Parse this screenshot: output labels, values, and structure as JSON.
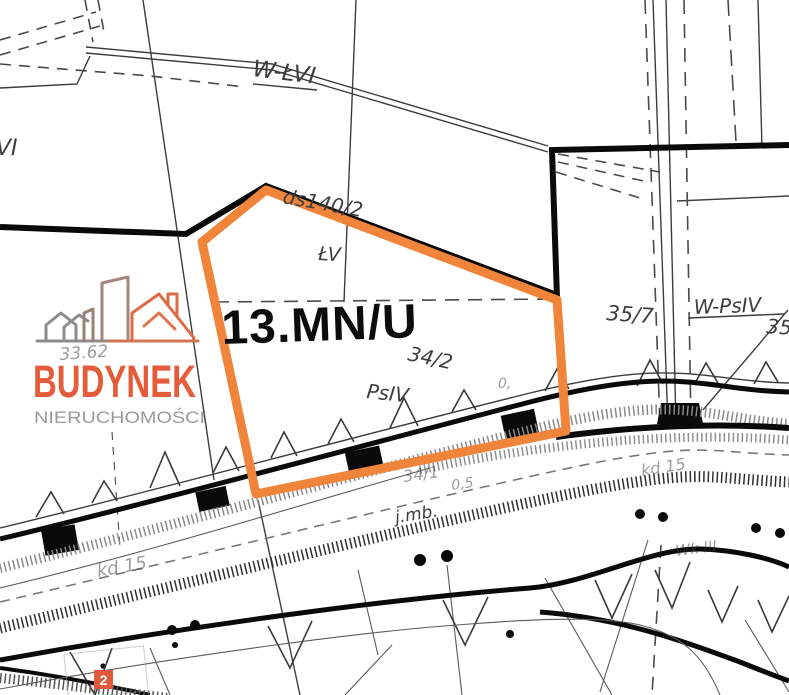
{
  "map": {
    "zone_label": "13.MN/U",
    "labels": {
      "wlvi": "W-ŁVI",
      "vi": "VI",
      "ds140": "ds140/2",
      "lv": "ŁV",
      "p34_2": "34/2",
      "psiv": "PsIV",
      "p35_7": "35/7",
      "wpsiv": "W-PsIV",
      "p35": "35",
      "jmb": "j.mb.",
      "p34_1": "34/1",
      "p0_5": "0,5",
      "zero": "0,",
      "kd15_right": "kd 15",
      "kd15_left": "kd 15",
      "wkiii": "Wk III",
      "n33_62": "33.62"
    },
    "marker": {
      "number": "2"
    }
  },
  "logo": {
    "name": "BUDYNEK",
    "subtitle": "NIERUCHOMOŚCI"
  },
  "colors": {
    "highlight": "#F1843B",
    "boundary": "#0a0a0a",
    "logo_orange": "#E55C3B",
    "logo_gray": "#9B9B9B",
    "marker_bg": "#E2593C",
    "marker_text": "#ffffff"
  }
}
